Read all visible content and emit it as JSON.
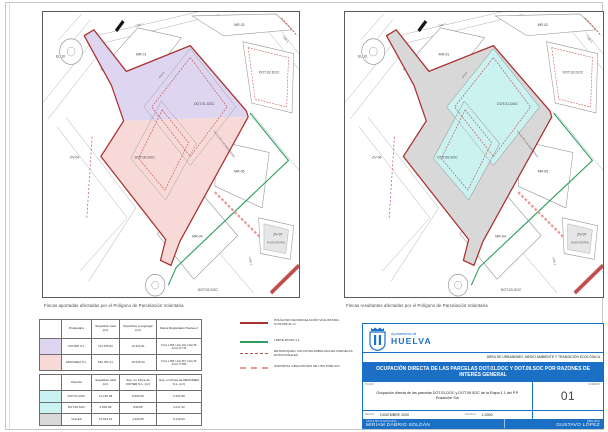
{
  "colors": {
    "accent_blue": "#1b6fc4",
    "boundary_red": "#a93230",
    "dash_red": "#c0504d",
    "limit_green": "#2f9e60",
    "parcel_purple": "#ded5f0",
    "parcel_pink": "#f7d9d7",
    "parcel_cyan": "#c9f2f1",
    "street_grey": "#d8d8d8",
    "swatch_grey": "#d9d9d9",
    "soportal_pink": "#e89a98"
  },
  "maps": {
    "left_caption": "Fincas aportadas afectadas por el Polígono de Parcelación Voluntaria",
    "right_caption": "Fincas resultantes afectadas por el Polígono de Parcelación Voluntaria",
    "labels": {
      "mr01": "MR-01",
      "mr02": "MR-02",
      "mr04": "MR-04",
      "mr05": "MR-05",
      "dot01": "DOT.01.DOC",
      "dot02": "DOT.02.DOC",
      "dot09": "DOT.09.SOC",
      "dot03": "DOT.03.SOC",
      "zv04": "ZV-04",
      "zv07": "ZV-07",
      "el10": "EL.10",
      "plaza": "PLAZA CENTRAL",
      "calle7": "Calle 7",
      "calle9": "Calle 9",
      "calle2": "Calle 2",
      "ingenieros": "CALLE DE LOS INGENIEROS",
      "calle": "CALLE"
    }
  },
  "table_fincas": {
    "headers": {
      "propietario": "Propietario",
      "total": "Superficie total (m²)",
      "segregar": "Superficie a segregar (m²)",
      "registro": "Datos Registrales Huelva-2"
    },
    "rows": [
      {
        "propietario": "CIOTER S.L.",
        "total": "114.979,26",
        "segregar": "14.344,91",
        "registro": "Tomo 1.805, Libro 202, Folio 58, Finca 47.734"
      },
      {
        "propietario": "DESCIREA S.L.",
        "total": "640.351,31",
        "segregar": "16.636,40",
        "registro": "Tomo 1.955, Libro 957, Folio 66, Finca 77.893"
      }
    ]
  },
  "table_parcelas": {
    "headers": {
      "parcela": "Parcela",
      "total": "Superficie total (m²)",
      "cioter": "Sup. en Finca de CIOTER S.L. (m²)",
      "descirea": "Sup. en Finca de DESCIREA S.L. (m²)"
    },
    "rows": [
      {
        "parcela": "DOT.01.DOC",
        "total": "14.195,08",
        "cioter": "8.992,50",
        "descirea": "5.202,58"
      },
      {
        "parcela": "DOT.09.SOC",
        "total": "4.863,08",
        "cioter": "845,86",
        "descirea": "4.017,22"
      },
      {
        "parcela": "VIALES",
        "total": "13.623,15",
        "cioter": "4.403,55",
        "descirea": "9.219,60"
      }
    ]
  },
  "legend": {
    "items": [
      {
        "style": "solid-red",
        "label": "POLÍGONO DE PARCELACIÓN VOLUNTARIA. S=32.686,31 m²"
      },
      {
        "style": "solid-green",
        "label": "LÍMITE ETAPA 1.1"
      },
      {
        "style": "dashed-red",
        "label": "RETRANQUEO CON ZONA ARBOLADA EN PARCELAS DOTACIONALES"
      },
      {
        "style": "dashed-pink",
        "label": "SOPORTAL OBLIGATORIO DE USO PÚBLICO"
      }
    ]
  },
  "title_block": {
    "org_small": "Ayuntamiento de",
    "org_big": "HUELVA",
    "area": "ÁREA DE URBANISMO, MEDIO AMBIENTE Y TRANSICIÓN ECOLÓGICA",
    "banner": "OCUPACIÓN DIRECTA DE LAS PARCELAS DOT.01.DOC Y DOT.09.SOC POR RAZONES DE INTERÉS GENERAL",
    "plano_label": "PLANO",
    "plano_text": "Ocupación directa de las parcelas DOT.01.DOC y DOT.09.SOC de la Etapa 1.1 del P.P. Ensanche Sur",
    "numero_label": "NÚMERO",
    "numero_value": "01",
    "fecha_label": "FECHA",
    "fecha_value": "DICIEMBRE 2020",
    "escala_label": "ESCALA",
    "escala_value": "1:2000",
    "arquitecta_label": "ARQUITECTA MUNICIPAL",
    "arquitecta_value": "MIRIAM DABRIO SOLDÁN",
    "dibujado_label": "DIBUJADO",
    "dibujado_value": "GUSTAVO LÓPEZ"
  }
}
